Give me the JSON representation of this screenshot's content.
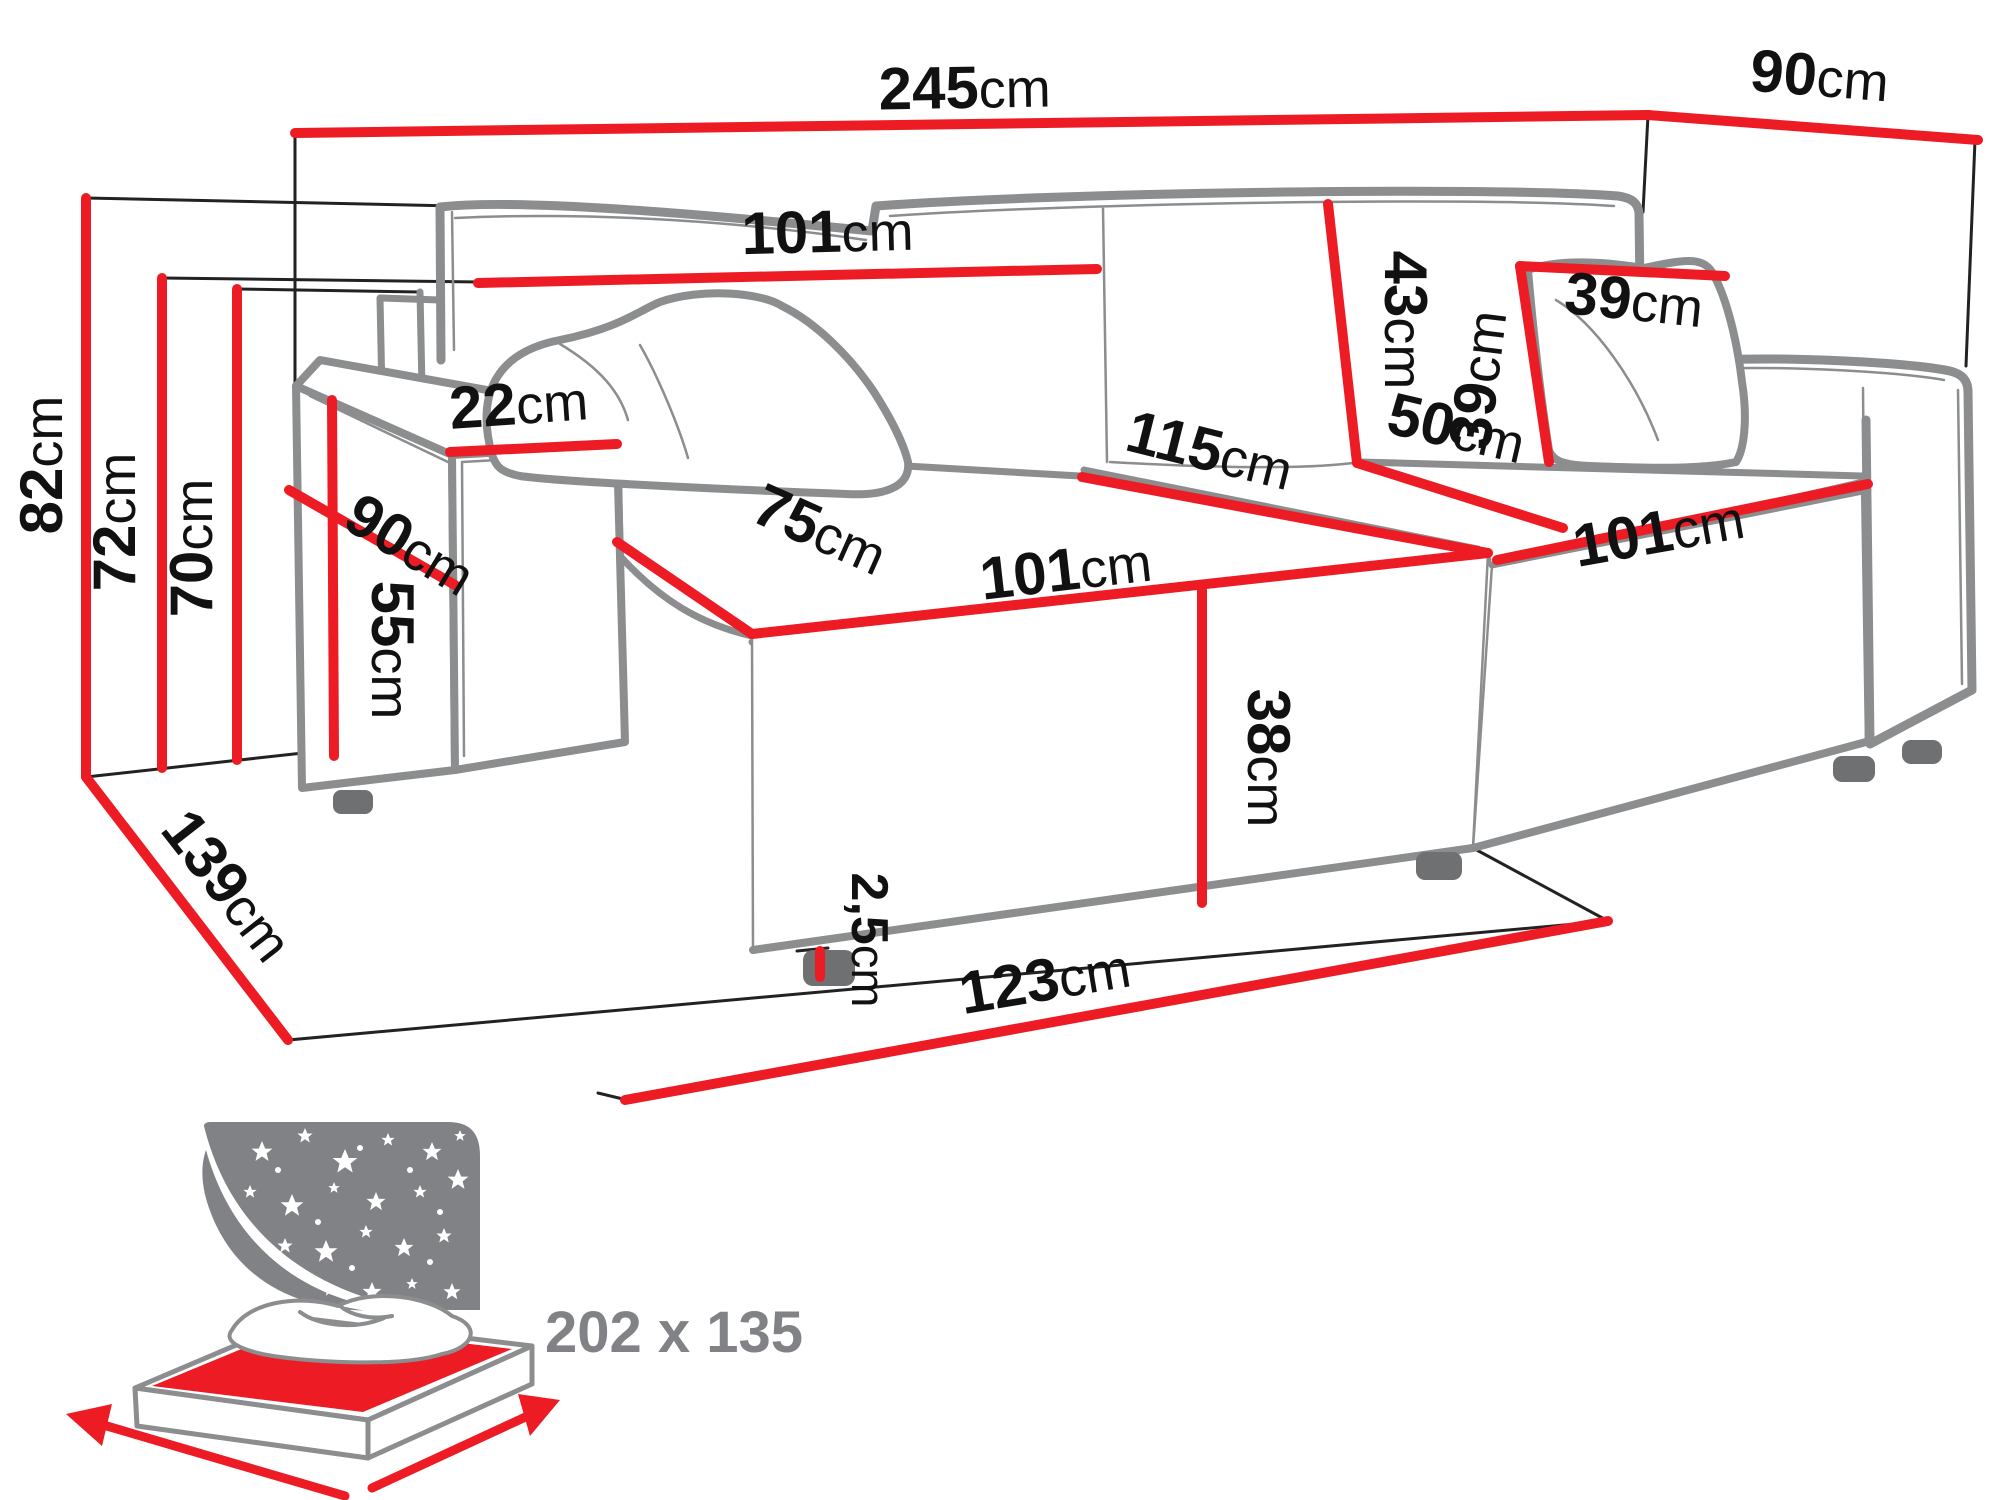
{
  "title": "corner-sofa-dimension-diagram",
  "colors": {
    "red": "#ed1c24",
    "sofa_gray": "#8b8d8e",
    "line_black": "#222222",
    "icon_gray": "#808285",
    "text_black": "#111111"
  },
  "dims": {
    "d245": {
      "value": "245",
      "unit": "cm"
    },
    "d90top": {
      "value": "90",
      "unit": "cm"
    },
    "d82": {
      "value": "82",
      "unit": "cm"
    },
    "d72": {
      "value": "72",
      "unit": "cm"
    },
    "d70": {
      "value": "70",
      "unit": "cm"
    },
    "d139": {
      "value": "139",
      "unit": "cm"
    },
    "d101back": {
      "value": "101",
      "unit": "cm"
    },
    "d22": {
      "value": "22",
      "unit": "cm"
    },
    "d90arm": {
      "value": "90",
      "unit": "cm"
    },
    "d55": {
      "value": "55",
      "unit": "cm"
    },
    "d75": {
      "value": "75",
      "unit": "cm"
    },
    "d101seat": {
      "value": "101",
      "unit": "cm"
    },
    "d115": {
      "value": "115",
      "unit": "cm"
    },
    "d43": {
      "value": "43",
      "unit": "cm"
    },
    "d50": {
      "value": "50",
      "unit": "cm"
    },
    "d39top": {
      "value": "39",
      "unit": "cm"
    },
    "d39left": {
      "value": "39",
      "unit": "cm"
    },
    "d101chaise": {
      "value": "101",
      "unit": "cm"
    },
    "d38": {
      "value": "38",
      "unit": "cm"
    },
    "d25": {
      "value": "2,5",
      "unit": "cm"
    },
    "d123": {
      "value": "123",
      "unit": "cm"
    }
  },
  "bed": {
    "size_label": "202 x 135"
  }
}
